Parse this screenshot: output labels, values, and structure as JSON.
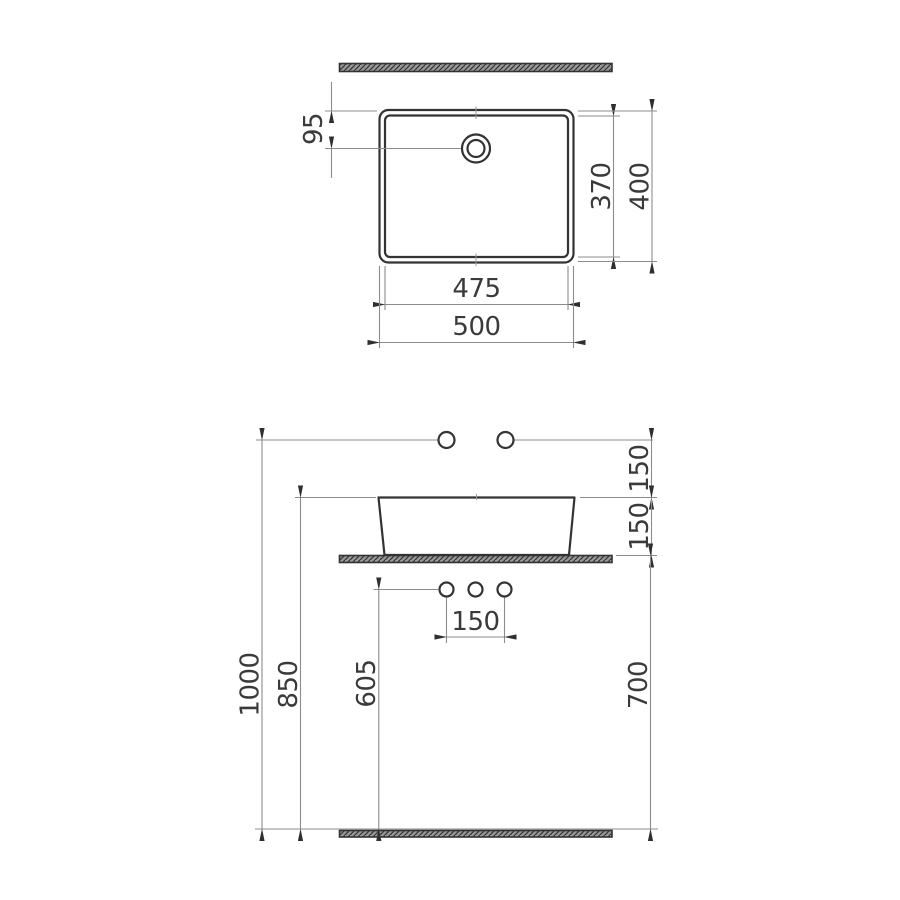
{
  "colors": {
    "object_line": "#333333",
    "dim_line": "#8c8c8c",
    "text_color": "#3a3a3a",
    "arrow_color": "#2f2f2f",
    "page_bg": "#ffffff"
  },
  "drawing": {
    "type": "washbasin technical dimension drawing",
    "top_view": {
      "labels": {
        "hole_offset": "95",
        "inner_depth": "370",
        "overall_depth": "400",
        "inner_width": "475",
        "overall_width": "500"
      }
    },
    "front_view": {
      "labels": {
        "supply_to_rim": "150",
        "rim_to_counter": "150",
        "drain_spacing": "150",
        "drain_to_floor": "605",
        "counter_to_floor": "700",
        "rim_to_floor": "850",
        "supply_to_floor": "1000"
      }
    }
  }
}
